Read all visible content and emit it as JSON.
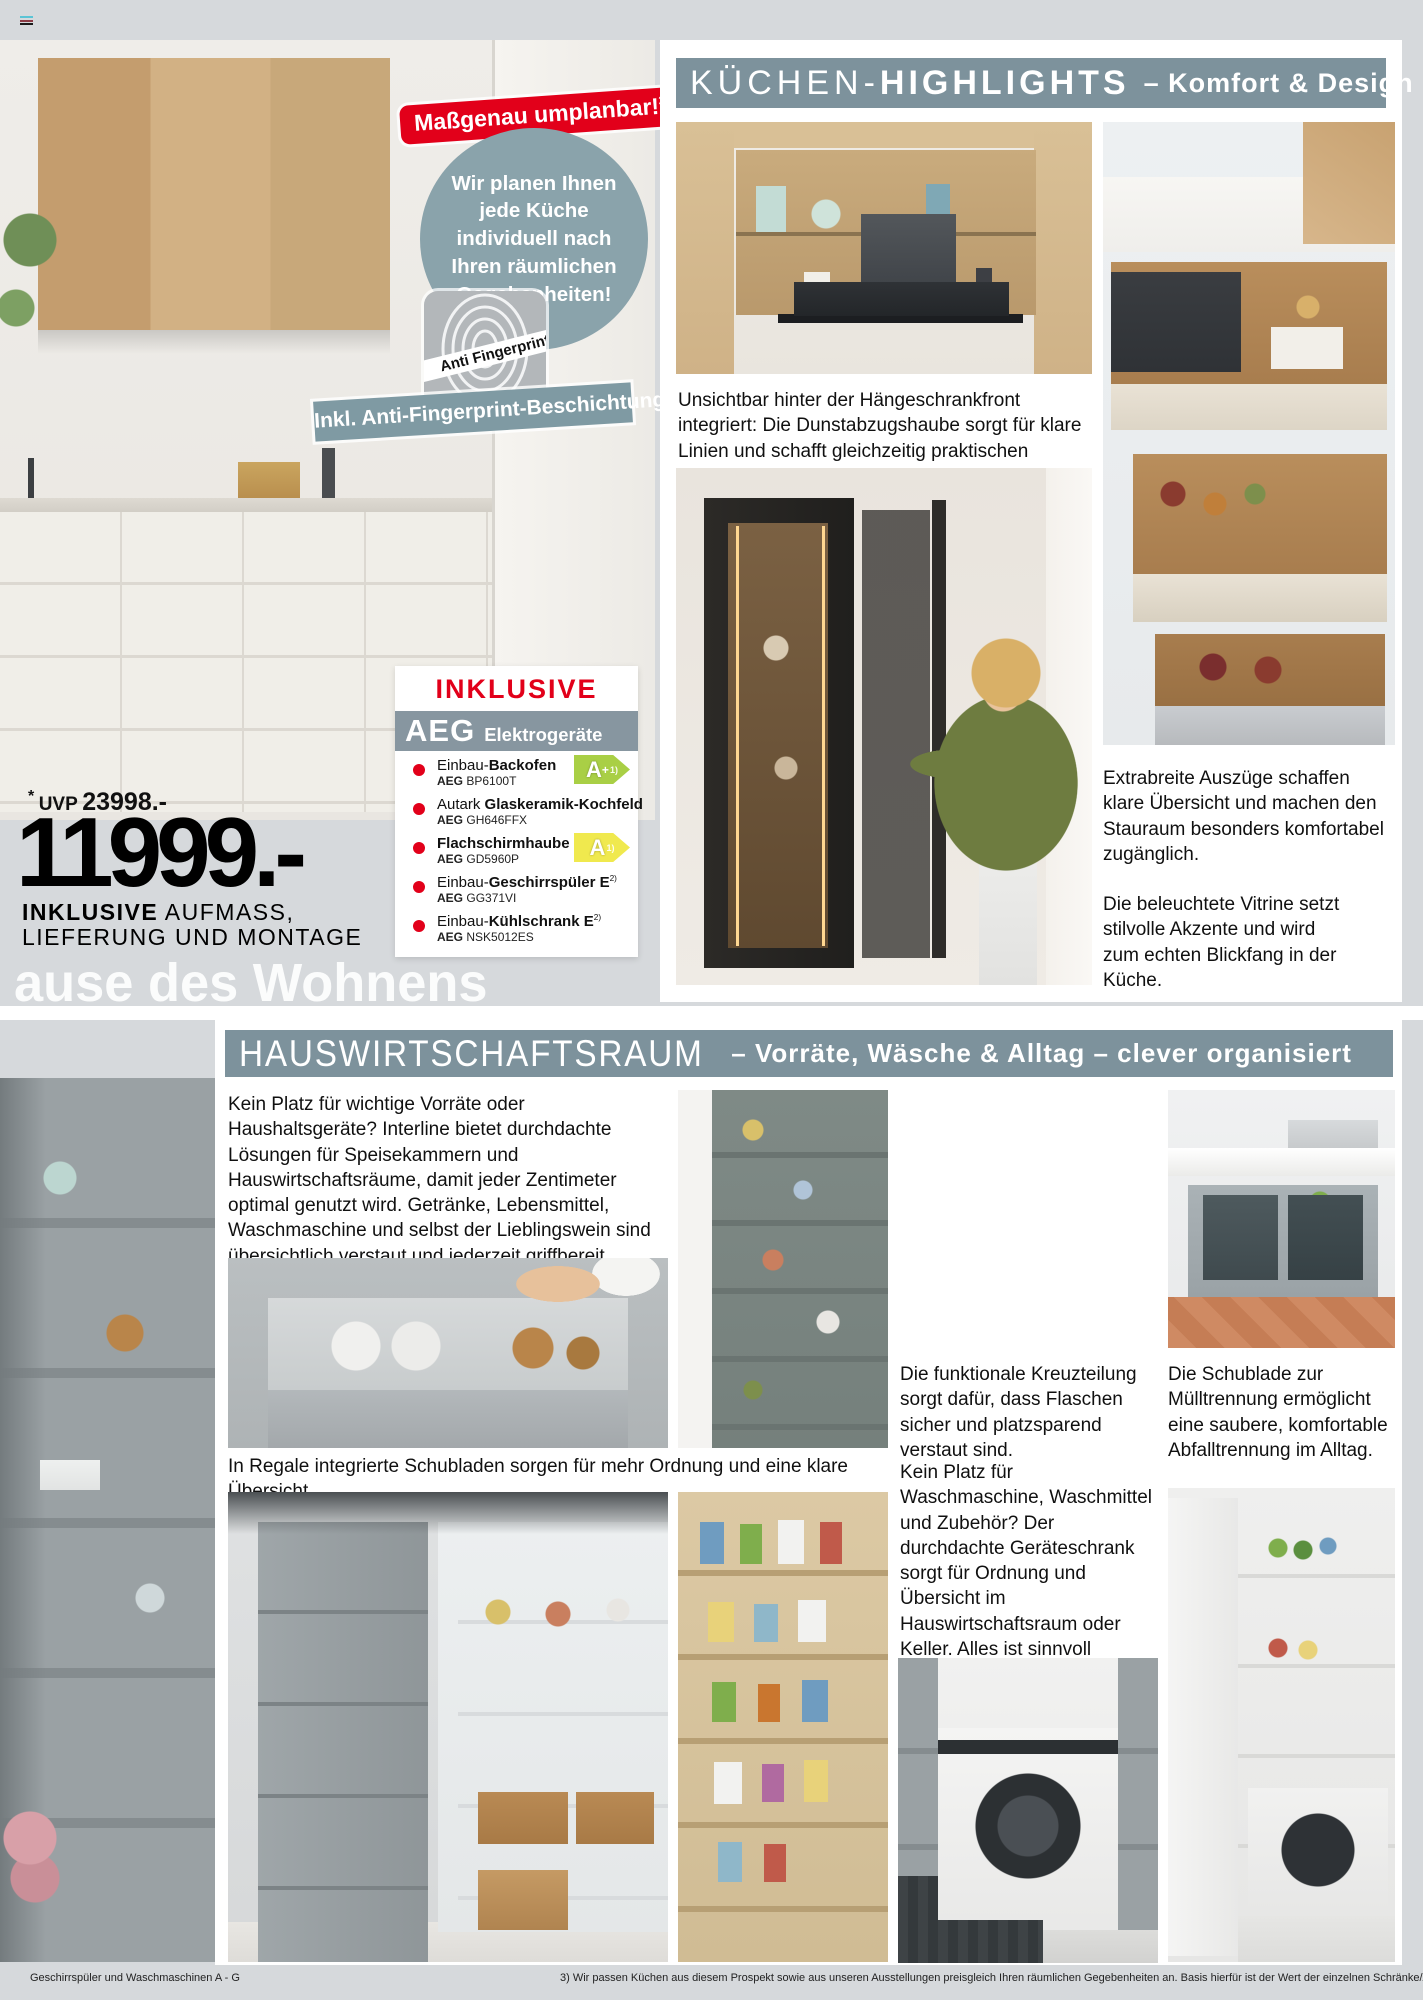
{
  "page": {
    "background": "#d6d9dc",
    "accent_red": "#e2001a",
    "bar_color": "#7d929c",
    "watermark": "ause des Wohnens",
    "footer": {
      "left": "Geschirrspüler und Waschmaschinen A - G",
      "note": "3) Wir passen Küchen aus diesem Prospekt sowie aus unseren Ausstellungen preisgleich Ihren räumlichen Gegebenheiten an. Basis hierfür ist der Wert der einzelnen Schränke/Artikel. Bei Maßüberschreitungen kann sich ein Aufpreis ergeben."
    }
  },
  "hero": {
    "badge_label": "Maßgenau umplanbar!",
    "badge_sup": "3)",
    "circle_text": "Wir planen Ihnen jede Küche individuell nach Ihren räumlichen Gegebenheiten!",
    "fingerprint_label": "Anti Fingerprint",
    "coating_banner": "Inkl. Anti-Fingerprint-Beschichtung",
    "uvp_star": "*",
    "uvp_label": "UVP",
    "uvp_value": "23998.-",
    "price": "11999.-",
    "note_bold": "INKLUSIVE",
    "note_rest1": " AUFMASS,",
    "note_rest2": "LIEFERUNG UND MONTAGE"
  },
  "inclusive": {
    "title": "INKLUSIVE",
    "brand": "AEG",
    "brand_suffix": "Elektrogeräte",
    "items": [
      {
        "pre": "Einbau-",
        "bold": "Backofen",
        "sup": "",
        "model_brand": "AEG",
        "model": "BP6100T"
      },
      {
        "pre": "Autark ",
        "bold": "Glaskeramik-Kochfeld",
        "sup": "",
        "model_brand": "AEG",
        "model": "GH646FFX"
      },
      {
        "pre": "",
        "bold": "Flachschirmhaube",
        "sup": "",
        "model_brand": "AEG",
        "model": "GD5960P"
      },
      {
        "pre": "Einbau-",
        "bold": "Geschirrspüler E",
        "sup": "2)",
        "model_brand": "AEG",
        "model": "GG371VI"
      },
      {
        "pre": "Einbau-",
        "bold": "Kühlschrank E",
        "sup": "2)",
        "model_brand": "AEG",
        "model": "NSK5012ES"
      }
    ],
    "energy_green": {
      "label": "A",
      "plus": "+",
      "note": "1)",
      "color": "#a9cf45"
    },
    "energy_yellow": {
      "label": "A",
      "plus": "",
      "note": "1)",
      "color": "#f0e94e"
    }
  },
  "highlights": {
    "title_light": "KÜCHEN-",
    "title_bold": "HIGHLIGHTS",
    "subtitle": "–  Komfort & Design",
    "caption_hood": "Unsichtbar hinter der Hängeschrankfront integriert: Die Dunstabzugshaube sorgt für klare Linien und schafft gleichzeitig praktischen Stauraum.",
    "caption_drawers": "Extrabreite Auszüge schaffen klare Übersicht und machen den Stauraum besonders komfortabel zugänglich.",
    "caption_vitrine": "Die beleuchtete Vitrine setzt stilvolle Akzente und wird zum echten Blickfang in der Küche."
  },
  "hwr": {
    "title": "HAUSWIRTSCHAFTSRAUM",
    "subtitle": "–  Vorräte, Wäsche & Alltag – clever organisiert",
    "intro": "Kein Platz für wichtige Vorräte oder Haushaltsgeräte? Interline bietet durchdachte Lösungen für Speisekammern und Hauswirtschaftsräume, damit jeder Zentimeter optimal genutzt wird. Getränke, Lebensmittel, Waschmaschine und selbst der Lieblingswein sind übersichtlich verstaut und jederzeit griffbereit.",
    "caption_shelf": "In Regale integrierte Schubladen sorgen für mehr Ordnung und eine klare Übersicht.",
    "caption_cross": "Die funktionale Kreuzteilung sorgt dafür, dass Flaschen sicher und platzsparend verstaut sind.",
    "caption_waste": "Die Schublade zur Mülltrennung ermöglicht eine saubere, komfortable Abfalltrennung im Alltag.",
    "caption_laundry": "Kein Platz für Waschmaschine, Waschmittel und Zubehör? Der durchdachte Geräteschrank sorgt für Ordnung und Übersicht im Hauswirtschaftsraum oder Keller. Alles ist sinnvoll verstaut, schnell zur Hand und genau dort, wo es im Alltag gebraucht wird."
  }
}
